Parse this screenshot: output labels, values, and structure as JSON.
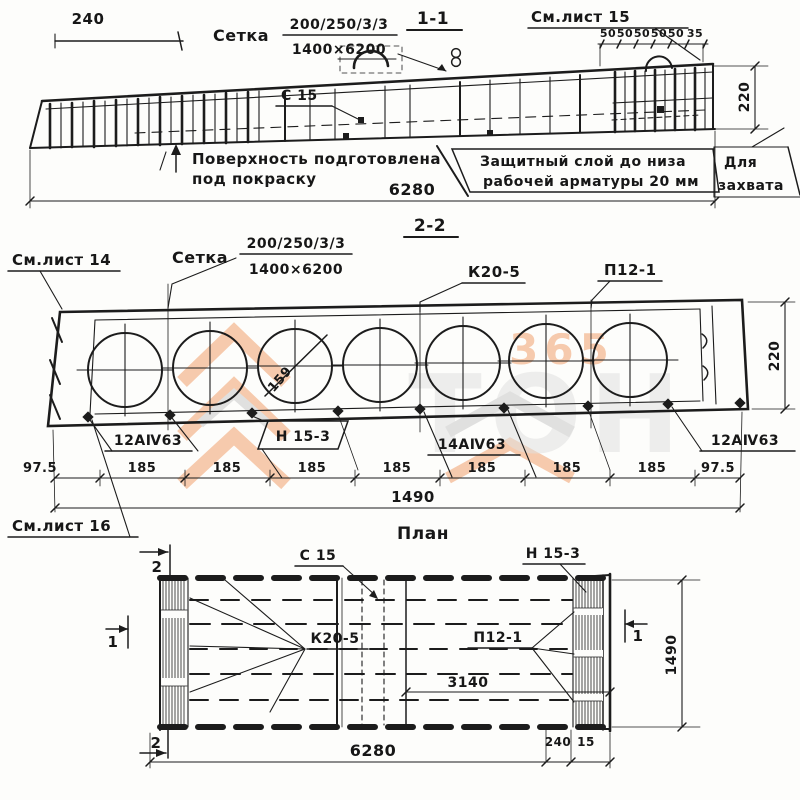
{
  "s11": {
    "title": "1-1",
    "see_sheet": "См.лист 15",
    "dim_240": "240",
    "mesh_word": "Сетка",
    "mesh_top": "200/250/3/3",
    "mesh_bottom": "1400×6200",
    "top_dims": [
      "50",
      "50",
      "50",
      "50",
      "50",
      "35"
    ],
    "dim_220": "220",
    "c15": "С 15",
    "note_surface_line1": "Поверхность подготовлена",
    "note_surface_line2": "под покраску",
    "note_cover_line1": "Защитный слой до низа",
    "note_cover_line2": "рабочей арматуры 20 мм",
    "grip_line1": "Для",
    "grip_line2": "захвата",
    "dim_total": "6280"
  },
  "s22": {
    "title": "2-2",
    "see_sheet_14": "См.лист 14",
    "see_sheet_16": "См.лист 16",
    "mesh_word": "Сетка",
    "mesh_top": "200/250/3/3",
    "mesh_bottom": "1400×6200",
    "label_k20": "К20-5",
    "label_p12": "П12-1",
    "dia": "159",
    "dim_220": "220",
    "bar_left": "12АⅣ63",
    "label_n15": "Н 15-3",
    "bar_mid": "14АⅣ63",
    "bar_right": "12АⅣ63",
    "dims": [
      "97.5",
      "185",
      "185",
      "185",
      "185",
      "185",
      "185",
      "185",
      "97.5"
    ],
    "dim_total": "1490"
  },
  "plan": {
    "title": "План",
    "label_c15": "С 15",
    "label_n15": "Н 15-3",
    "label_k20": "К20-5",
    "label_p12": "П12-1",
    "dim_3140": "3140",
    "dim_1490": "1490",
    "dim_240": "240",
    "dim_15": "15",
    "dim_total": "6280",
    "marker_1": "1",
    "marker_2": "2"
  },
  "watermark": {
    "digits": "365",
    "letters": "ТОН"
  },
  "colors": {
    "ink": "#1c1c1c",
    "paper": "#fdfdfb",
    "wm_orange": "#f2a26e",
    "wm_gray": "#c9c9c9"
  }
}
